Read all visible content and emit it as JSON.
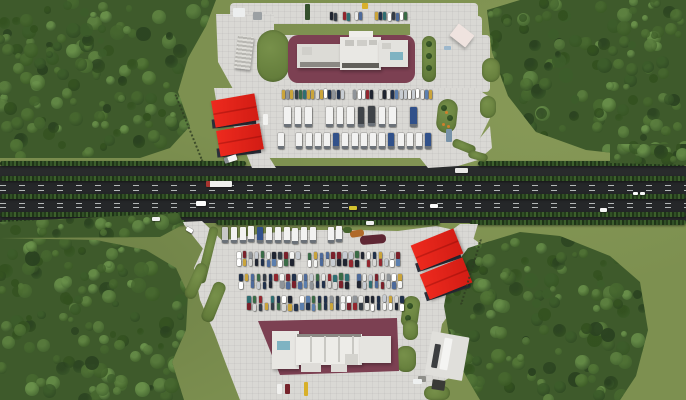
{
  "canvas": {
    "w": 686,
    "h": 400
  },
  "palette": {
    "grass": "#7d9050",
    "forest_base": "#3e5a2b",
    "tree_colors": [
      "#2a4220",
      "#33511f",
      "#3c5c2a",
      "#47682f",
      "#527536",
      "#5d8140",
      "#69904a"
    ],
    "asphalt": "#292b2c",
    "carriageway": "#252729",
    "pavement": "#d9d8d4",
    "apron": "#7c4052",
    "red_roof": "#ee2a1e",
    "red_roof_dark": "#d21c14",
    "canopy_wall": "#2c313c",
    "building_white": "#e9e8e4",
    "teal_skylight": "#7fb3c2",
    "truck_white": "#f2f2f1",
    "truck_accents": [
      "#a8322e",
      "#31518a",
      "#3f4348",
      "#c8c8c6"
    ],
    "car_colors": [
      "#f4f4f2",
      "#e9e9e7",
      "#20304a",
      "#7a202a",
      "#2e6e72",
      "#1f2430",
      "#c7ccd2",
      "#4d6a9a",
      "#8f9499",
      "#caa43a",
      "#3a6b46",
      "#ffffff",
      "#d8d8d6",
      "#343c46",
      "#5b7fae",
      "#93262e"
    ]
  },
  "highway": {
    "band": {
      "x": 0,
      "y": 166,
      "w": 686,
      "h": 57
    },
    "carriageways": [
      {
        "x": 0,
        "y": 180,
        "w": 686,
        "h": 14
      },
      {
        "x": 0,
        "y": 199,
        "w": 686,
        "h": 13
      }
    ],
    "dashes": [
      {
        "x": 0,
        "y": 185,
        "w": 686
      },
      {
        "x": 0,
        "y": 189.5,
        "w": 686
      },
      {
        "x": 0,
        "y": 202.5,
        "w": 686
      },
      {
        "x": 0,
        "y": 207,
        "w": 686
      }
    ],
    "hedges": [
      {
        "x": 0,
        "y": 161,
        "w": 246
      },
      {
        "x": 478,
        "y": 161,
        "w": 208
      },
      {
        "x": 0,
        "y": 176,
        "w": 686
      },
      {
        "x": 0,
        "y": 194,
        "w": 686
      },
      {
        "x": 0,
        "y": 212,
        "w": 686
      },
      {
        "x": 0,
        "y": 220,
        "w": 186
      },
      {
        "x": 216,
        "y": 220,
        "w": 224
      },
      {
        "x": 470,
        "y": 220,
        "w": 216
      }
    ]
  },
  "pavements": [
    {
      "name": "north-plaza-top-road",
      "rect": [
        230,
        3,
        248,
        21
      ]
    },
    {
      "name": "north-plaza-ne-pad",
      "rect": [
        410,
        16,
        72,
        46
      ]
    },
    {
      "name": "north-plaza-upper",
      "rect": [
        272,
        35,
        218,
        57
      ]
    },
    {
      "name": "north-plaza-west-wedge",
      "poly": "216,14 274,14 274,92 238,98 218,62"
    },
    {
      "name": "north-plaza-main",
      "poly": "214,88 476,88 488,96 490,118 480,138 454,150 428,158 400,158 270,158 248,150 232,124 216,100"
    },
    {
      "name": "south-plaza-main",
      "poly": "204,246 226,240 258,234 300,230 354,230 398,231 436,226 464,232 478,242 480,266 470,290 452,310 442,324 440,336 462,344 460,372 442,382 432,400 240,400 226,364 214,332 200,300 194,268"
    }
  ],
  "ramps": [
    {
      "name": "north-entry-ramp",
      "poly": "244,148 262,146 276,168 252,168"
    },
    {
      "name": "north-exit-merge",
      "poly": "420,158 452,148 480,138 490,126 492,148 478,160 458,166 428,168"
    },
    {
      "name": "south-entry-ramp",
      "poly": "182,222 202,221 228,246 204,250"
    },
    {
      "name": "south-exit-merge",
      "poly": "436,242 460,224 478,224 472,244 452,250"
    }
  ],
  "forests": [
    {
      "name": "forest-top-left",
      "poly": "0,0 216,0 206,26 188,58 178,92 190,126 170,148 140,158 0,158",
      "bbox": [
        0,
        0,
        218,
        158
      ],
      "count": 155,
      "seed": 101
    },
    {
      "name": "forest-top-right",
      "poly": "487,10 520,0 686,0 686,150 640,156 586,150 536,132 508,96 492,52",
      "bbox": [
        487,
        0,
        199,
        156
      ],
      "count": 150,
      "seed": 202
    },
    {
      "name": "forest-bottom-left",
      "poly": "0,238 96,240 146,250 176,268 188,294 186,330 172,362 184,400 0,400",
      "bbox": [
        0,
        238,
        190,
        162
      ],
      "count": 140,
      "seed": 303
    },
    {
      "name": "forest-bottom-right",
      "poly": "468,248 520,232 560,236 610,256 640,282 648,330 636,376 620,400 480,400 452,352 444,306 450,272",
      "bbox": [
        444,
        232,
        206,
        168
      ],
      "count": 150,
      "seed": 404
    },
    {
      "name": "tree-line-north-right",
      "poly": "610,144 686,144 686,165 610,163",
      "bbox": [
        610,
        144,
        76,
        20
      ],
      "count": 18,
      "seed": 505
    },
    {
      "name": "tree-line-south-left",
      "poly": "0,222 178,213 184,224 160,237 0,238",
      "bbox": [
        0,
        213,
        184,
        24
      ],
      "count": 24,
      "seed": 606
    }
  ],
  "grass_islands": [
    {
      "name": "island-west-wedge",
      "x": 257,
      "y": 30,
      "w": 32,
      "h": 52,
      "rx": 16
    },
    {
      "name": "island-pill",
      "x": 422,
      "y": 36,
      "w": 14,
      "h": 46,
      "rx": 7,
      "dots": [
        [
          429,
          44
        ],
        [
          429,
          56
        ],
        [
          429,
          68
        ]
      ]
    },
    {
      "name": "island-teardrop-north",
      "x": 437,
      "y": 99,
      "w": 20,
      "h": 34,
      "rx": 10,
      "rot": 6,
      "dots": [
        [
          444,
          108
        ],
        [
          450,
          118
        ]
      ],
      "flowers": [
        [
          443,
          124
        ],
        [
          448,
          126
        ],
        [
          446,
          112
        ]
      ]
    },
    {
      "name": "island-scallop-1",
      "x": 482,
      "y": 58,
      "w": 18,
      "h": 24,
      "rx": 9
    },
    {
      "name": "island-scallop-2",
      "x": 480,
      "y": 96,
      "w": 16,
      "h": 22,
      "rx": 8
    },
    {
      "name": "island-claw-gap-1",
      "x": 452,
      "y": 142,
      "w": 24,
      "h": 9,
      "rx": 4,
      "rot": 22
    },
    {
      "name": "island-claw-gap-2",
      "x": 468,
      "y": 152,
      "w": 20,
      "h": 8,
      "rx": 4,
      "rot": 16
    },
    {
      "name": "island-ramp-strip",
      "x": 203,
      "y": 226,
      "w": 9,
      "h": 58,
      "rx": 4,
      "rot": 14
    },
    {
      "name": "island-finger-1",
      "x": 190,
      "y": 262,
      "w": 12,
      "h": 38,
      "rx": 6,
      "rot": 24
    },
    {
      "name": "island-finger-2",
      "x": 207,
      "y": 281,
      "w": 13,
      "h": 42,
      "rx": 6,
      "rot": 22
    },
    {
      "name": "island-teardrop-south",
      "x": 402,
      "y": 296,
      "w": 17,
      "h": 32,
      "rx": 8,
      "rot": 8,
      "dots": [
        [
          410,
          306
        ],
        [
          408,
          318
        ]
      ]
    },
    {
      "name": "island-patch-1",
      "x": 403,
      "y": 320,
      "w": 15,
      "h": 20,
      "rx": 7
    },
    {
      "name": "island-patch-2",
      "x": 396,
      "y": 346,
      "w": 20,
      "h": 26,
      "rx": 9
    },
    {
      "name": "island-patch-3",
      "x": 424,
      "y": 386,
      "w": 26,
      "h": 14,
      "rx": 7
    },
    {
      "name": "flowerbed-orange",
      "x": 350,
      "y": 230,
      "w": 14,
      "h": 7,
      "rx": 3,
      "color": "#b06a2a",
      "rot": -8
    },
    {
      "name": "flowerbed-maroon",
      "x": 360,
      "y": 235,
      "w": 26,
      "h": 9,
      "rx": 4,
      "color": "#5e2633",
      "rot": -5
    },
    {
      "name": "flowerbed-bush",
      "x": 343,
      "y": 227,
      "w": 9,
      "h": 6,
      "rx": 3,
      "color": "#44622c"
    }
  ],
  "aprons": [
    {
      "name": "north-building-apron",
      "rect": [
        288,
        35,
        127,
        48
      ],
      "rx": 10
    },
    {
      "name": "south-building-apron",
      "poly": "258,321 397,318 399,371 280,375"
    }
  ],
  "buildings": {
    "north": [
      [
        297,
        44,
        45,
        24,
        "#dcdbd6"
      ],
      [
        340,
        37,
        41,
        33,
        "#e9e8e4"
      ],
      [
        379,
        40,
        29,
        27,
        "#e3e2de"
      ],
      [
        345,
        40,
        9,
        6,
        "#c6c5c0"
      ],
      [
        357,
        40,
        10,
        6,
        "#cfcec9"
      ],
      [
        369,
        40,
        8,
        5,
        "#c6c5c0"
      ],
      [
        382,
        43,
        9,
        6,
        "#cfcec9"
      ],
      [
        302,
        47,
        10,
        8,
        "#d0cfca"
      ],
      [
        349,
        31,
        24,
        6,
        "#efeeea"
      ],
      [
        300,
        62,
        40,
        5,
        "#8b8984"
      ],
      [
        342,
        63,
        37,
        5,
        "#615f5a"
      ],
      [
        390,
        52,
        13,
        8,
        "#7fb3c2"
      ]
    ],
    "south": [
      [
        272,
        331,
        27,
        38,
        "#e7e6e2"
      ],
      [
        296,
        334,
        66,
        31,
        "#edece8"
      ],
      [
        360,
        336,
        31,
        27,
        "#e5e4e0"
      ],
      [
        297,
        334,
        64,
        3,
        "#8b8984"
      ],
      [
        310,
        336,
        2,
        26,
        "#c9c8c3"
      ],
      [
        324,
        336,
        2,
        26,
        "#c9c8c3"
      ],
      [
        338,
        336,
        2,
        26,
        "#c9c8c3"
      ],
      [
        352,
        336,
        2,
        26,
        "#c9c8c3"
      ],
      [
        301,
        363,
        20,
        9,
        "#dedcd8"
      ],
      [
        331,
        364,
        16,
        8,
        "#dedcd8"
      ],
      [
        345,
        354,
        13,
        11,
        "#d4d3ce"
      ],
      [
        277,
        341,
        13,
        9,
        "#7fb3c2"
      ]
    ]
  },
  "fuel_canopies": [
    {
      "name": "north-canopy-1",
      "cx": 235,
      "cy": 110,
      "w": 44,
      "h": 27,
      "rot": -10
    },
    {
      "name": "north-canopy-2",
      "cx": 240,
      "cy": 140,
      "w": 44,
      "h": 26,
      "rot": -10
    },
    {
      "name": "south-canopy-1",
      "cx": 437,
      "cy": 249,
      "w": 46,
      "h": 27,
      "rot": -22
    },
    {
      "name": "south-canopy-2",
      "cx": 446,
      "cy": 278,
      "w": 46,
      "h": 27,
      "rot": -22
    }
  ],
  "props": [
    {
      "name": "car-wash-building",
      "x": 236,
      "y": 36,
      "w": 16,
      "h": 33,
      "rot": 7,
      "stripes": true
    },
    {
      "name": "kiosk-building",
      "x": 452,
      "y": 28,
      "w": 20,
      "h": 15,
      "rot": 38,
      "color": "#efe3df",
      "shadow": true
    },
    {
      "name": "box-truck",
      "x": 233,
      "y": 8,
      "w": 12,
      "h": 9,
      "color": "#eceeee"
    },
    {
      "name": "gray-van",
      "x": 253,
      "y": 12,
      "w": 9,
      "h": 8,
      "color": "#9ba0a3"
    },
    {
      "name": "yellow-shed",
      "x": 362,
      "y": 3,
      "w": 6,
      "h": 6,
      "color": "#d8b02a"
    },
    {
      "name": "green-container",
      "x": 305,
      "y": 4,
      "w": 5,
      "h": 16,
      "color": "#34502c"
    },
    {
      "name": "blue-car",
      "x": 444,
      "y": 46,
      "w": 7,
      "h": 4,
      "color": "#9db8cc"
    },
    {
      "name": "white-van-north",
      "x": 263,
      "y": 114,
      "w": 5,
      "h": 11,
      "color": "#f2f2f0"
    },
    {
      "name": "bus-north",
      "x": 446,
      "y": 129,
      "w": 6,
      "h": 13,
      "color": "#7792a8"
    },
    {
      "name": "weighbridge-pad",
      "x": 428,
      "y": 334,
      "w": 38,
      "h": 44,
      "rot": 10,
      "color": "#e0dfdb"
    },
    {
      "name": "truck-on-pad",
      "x": 442,
      "y": 338,
      "w": 8,
      "h": 32,
      "rot": 10,
      "color": "#f4f4f2"
    },
    {
      "name": "dark-truck-on-pad",
      "x": 433,
      "y": 344,
      "w": 6,
      "h": 24,
      "rot": 10,
      "color": "#3c3e40"
    },
    {
      "name": "shed-dark",
      "x": 432,
      "y": 380,
      "w": 13,
      "h": 10,
      "rot": 8,
      "color": "#3a3a36"
    },
    {
      "name": "shed-gray",
      "x": 418,
      "y": 376,
      "w": 8,
      "h": 6,
      "color": "#8f8f8a"
    },
    {
      "name": "fuel-pump-island",
      "x": 304,
      "y": 382,
      "w": 4,
      "h": 14,
      "color": "#d8b02a"
    },
    {
      "name": "car-white-south",
      "x": 277,
      "y": 384,
      "w": 5,
      "h": 10,
      "color": "#f0f0ee"
    },
    {
      "name": "car-red-south",
      "x": 285,
      "y": 384,
      "w": 5,
      "h": 10,
      "color": "#76232b"
    },
    {
      "name": "car-white-south-2",
      "x": 413,
      "y": 379,
      "w": 9,
      "h": 5,
      "color": "#eef0f0"
    }
  ],
  "parking_rows": [
    {
      "name": "north-car-row",
      "x": 282,
      "y": 90,
      "count": 36,
      "pitch": 4.2,
      "w": 3,
      "h": 9,
      "type": "car",
      "seed": 11
    },
    {
      "name": "north-truck-row-1",
      "x": 284,
      "y": 107,
      "count": 13,
      "pitch": 10.5,
      "w": 6.5,
      "h": 20,
      "type": "truck",
      "seed": 22
    },
    {
      "name": "north-truck-row-2",
      "x": 278,
      "y": 133,
      "count": 17,
      "pitch": 9.2,
      "w": 6,
      "h": 16,
      "type": "truck",
      "seed": 33
    },
    {
      "name": "top-road-cars-1",
      "x": 330,
      "y": 12,
      "count": 8,
      "pitch": 4.2,
      "w": 3,
      "h": 8,
      "type": "car",
      "seed": 70
    },
    {
      "name": "top-road-cars-2",
      "x": 375,
      "y": 12,
      "count": 8,
      "pitch": 4.2,
      "w": 3,
      "h": 8,
      "type": "car",
      "seed": 71
    },
    {
      "name": "south-truck-row",
      "x": 222,
      "y": 227,
      "count": 14,
      "pitch": 8.8,
      "w": 6,
      "h": 16,
      "type": "truck",
      "seed": 44
    },
    {
      "name": "south-car-band1-a",
      "x": 237,
      "y": 252,
      "count": 28,
      "pitch": 5.9,
      "w": 3.6,
      "h": 7,
      "type": "car",
      "seed": 55
    },
    {
      "name": "south-car-band1-b",
      "x": 237,
      "y": 259.5,
      "count": 28,
      "pitch": 5.9,
      "w": 3.6,
      "h": 7,
      "type": "car",
      "seed": 56
    },
    {
      "name": "south-car-band2-a",
      "x": 239,
      "y": 274,
      "count": 28,
      "pitch": 5.9,
      "w": 3.6,
      "h": 7,
      "type": "car",
      "seed": 57
    },
    {
      "name": "south-car-band2-b",
      "x": 239,
      "y": 281.5,
      "count": 28,
      "pitch": 5.9,
      "w": 3.6,
      "h": 7,
      "type": "car",
      "seed": 58
    },
    {
      "name": "south-car-band3-a",
      "x": 247,
      "y": 296,
      "count": 27,
      "pitch": 5.9,
      "w": 3.6,
      "h": 7,
      "type": "car",
      "seed": 59
    },
    {
      "name": "south-car-band3-b",
      "x": 247,
      "y": 303.5,
      "count": 27,
      "pitch": 5.9,
      "w": 3.6,
      "h": 7,
      "type": "car",
      "seed": 60
    }
  ],
  "road_vehicles": [
    {
      "name": "semi-truck-westbound",
      "x": 206,
      "y": 181,
      "w": 26,
      "h": 6,
      "color": "#f0f0ee",
      "cab": "#a83530"
    },
    {
      "name": "white-van-highway",
      "x": 196,
      "y": 201,
      "w": 10,
      "h": 5,
      "color": "#fdfdfc"
    },
    {
      "name": "yellow-car",
      "x": 349,
      "y": 206,
      "w": 8,
      "h": 4,
      "color": "#d4c32e"
    },
    {
      "name": "white-car-1",
      "x": 366,
      "y": 221,
      "w": 8,
      "h": 4,
      "color": "#eeeeee"
    },
    {
      "name": "truck-service-lane",
      "x": 455,
      "y": 168,
      "w": 13,
      "h": 5,
      "color": "#e8e8e6"
    },
    {
      "name": "white-car-2",
      "x": 633,
      "y": 192,
      "w": 5,
      "h": 3,
      "color": "#ffffff"
    },
    {
      "name": "white-car-3",
      "x": 640,
      "y": 192,
      "w": 5,
      "h": 3,
      "color": "#f6f6f6"
    },
    {
      "name": "white-car-4",
      "x": 600,
      "y": 208,
      "w": 7,
      "h": 4,
      "color": "#f4f4f4"
    },
    {
      "name": "white-car-5",
      "x": 430,
      "y": 204,
      "w": 8,
      "h": 4,
      "color": "#fafafa"
    },
    {
      "name": "white-car-6",
      "x": 152,
      "y": 217,
      "w": 8,
      "h": 4,
      "color": "#f2f2f2"
    },
    {
      "name": "truck-on-north-ramp",
      "x": 224,
      "y": 156,
      "w": 13,
      "h": 6,
      "rot": -18,
      "color": "#f4f4f2",
      "cab": "#8a8f94"
    },
    {
      "name": "car-on-south-ramp",
      "x": 186,
      "y": 228,
      "w": 7,
      "h": 4,
      "rot": 30,
      "color": "#ffffff"
    }
  ],
  "fences": [
    {
      "name": "fence-north-west",
      "x": 188,
      "y": 92,
      "len": 72,
      "rot": -22
    },
    {
      "name": "fence-south-east",
      "x": 470,
      "y": 238,
      "len": 68,
      "rot": 17
    }
  ]
}
